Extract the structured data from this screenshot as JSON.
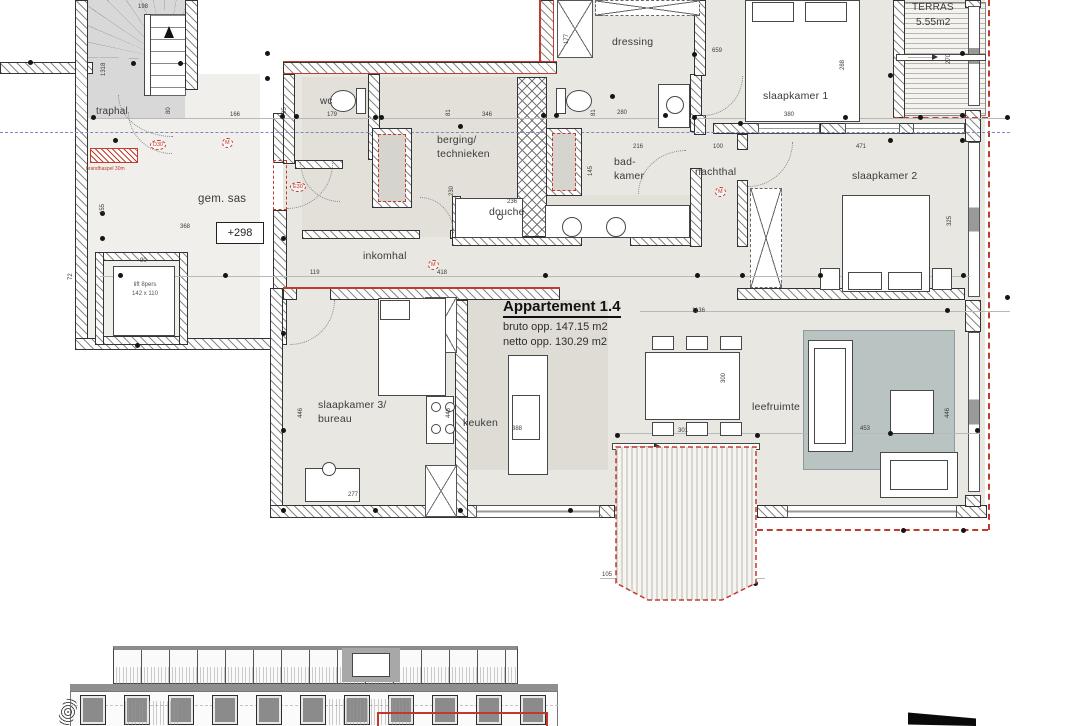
{
  "drawing": {
    "title": "Appartement 1.4",
    "bruto": "bruto opp. 147.15 m2",
    "netto": "netto opp. 130.29 m2",
    "level_marker": "+298",
    "fire_label": "brandhaspel 30m",
    "lift_line1": "lift 8pers",
    "lift_line2": "142 x 110"
  },
  "colors": {
    "accent_red": "#bf3d2e",
    "section_blue": "#7f88bd",
    "floor_beige": "#e9e7e1",
    "rug_gray": "#b9c3c2"
  },
  "room_labels": [
    {
      "text": "traphal",
      "x": 96,
      "y": 106,
      "fs": 10
    },
    {
      "text": "gem. sas",
      "x": 198,
      "y": 193,
      "fs": 11.5
    },
    {
      "text": "wc",
      "x": 320,
      "y": 96,
      "fs": 10
    },
    {
      "text": "berging/",
      "x": 437,
      "y": 134,
      "fs": 10.5
    },
    {
      "text": "technieken",
      "x": 437,
      "y": 148,
      "fs": 10.5
    },
    {
      "text": "douche",
      "x": 489,
      "y": 206,
      "fs": 10.5
    },
    {
      "text": "bad-",
      "x": 614,
      "y": 156,
      "fs": 10.5
    },
    {
      "text": "kamer",
      "x": 614,
      "y": 170,
      "fs": 10.5
    },
    {
      "text": "dressing",
      "x": 612,
      "y": 36,
      "fs": 10.5
    },
    {
      "text": "slaapkamer 1",
      "x": 763,
      "y": 90,
      "fs": 10.5
    },
    {
      "text": "nachthal",
      "x": 695,
      "y": 166,
      "fs": 10.5
    },
    {
      "text": "slaapkamer 2",
      "x": 852,
      "y": 170,
      "fs": 10.5
    },
    {
      "text": "inkomhal",
      "x": 363,
      "y": 250,
      "fs": 10.5
    },
    {
      "text": "slaapkamer 3/",
      "x": 318,
      "y": 399,
      "fs": 10.5
    },
    {
      "text": "bureau",
      "x": 318,
      "y": 413,
      "fs": 10.5
    },
    {
      "text": "keuken",
      "x": 463,
      "y": 417,
      "fs": 10.5
    },
    {
      "text": "leefruimte",
      "x": 752,
      "y": 401,
      "fs": 10.5
    }
  ],
  "terrace_labels": [
    {
      "text": "TERRAS",
      "x": 912,
      "y": 2,
      "fs": 10
    },
    {
      "text": "5.55m2",
      "x": 916,
      "y": 17,
      "fs": 10
    },
    {
      "text": "TERRAS",
      "x": 645,
      "y": 529,
      "fs": 11
    },
    {
      "text": "11.2m2",
      "x": 648,
      "y": 547,
      "fs": 11
    }
  ],
  "dimensions": [
    {
      "t": "198",
      "x": 138,
      "y": 4
    },
    {
      "t": "1318",
      "x": 107,
      "y": 58,
      "v": 1
    },
    {
      "t": "80",
      "x": 172,
      "y": 96,
      "v": 1
    },
    {
      "t": "155",
      "x": 106,
      "y": 196,
      "v": 1
    },
    {
      "t": "166",
      "x": 230,
      "y": 112
    },
    {
      "t": "368",
      "x": 180,
      "y": 224
    },
    {
      "t": "90",
      "x": 140,
      "y": 258
    },
    {
      "t": "72",
      "x": 74,
      "y": 262,
      "v": 1
    },
    {
      "t": "179",
      "x": 327,
      "y": 112
    },
    {
      "t": "95",
      "x": 288,
      "y": 96,
      "v": 1
    },
    {
      "t": "346",
      "x": 482,
      "y": 112
    },
    {
      "t": "81",
      "x": 452,
      "y": 98,
      "v": 1
    },
    {
      "t": "230",
      "x": 455,
      "y": 178,
      "v": 1
    },
    {
      "t": "280",
      "x": 617,
      "y": 110
    },
    {
      "t": "81",
      "x": 597,
      "y": 98,
      "v": 1
    },
    {
      "t": "216",
      "x": 633,
      "y": 144
    },
    {
      "t": "145",
      "x": 594,
      "y": 158,
      "v": 1
    },
    {
      "t": "100",
      "x": 713,
      "y": 144
    },
    {
      "t": "236",
      "x": 507,
      "y": 199
    },
    {
      "t": "119",
      "x": 310,
      "y": 270
    },
    {
      "t": "418",
      "x": 437,
      "y": 270
    },
    {
      "t": "659",
      "x": 712,
      "y": 48
    },
    {
      "t": "288",
      "x": 846,
      "y": 52,
      "v": 1
    },
    {
      "t": "177",
      "x": 570,
      "y": 26,
      "v": 1
    },
    {
      "t": "380",
      "x": 784,
      "y": 112
    },
    {
      "t": "471",
      "x": 856,
      "y": 144
    },
    {
      "t": "270",
      "x": 952,
      "y": 46,
      "v": 1
    },
    {
      "t": "1136",
      "x": 692,
      "y": 308
    },
    {
      "t": "446",
      "x": 304,
      "y": 400,
      "v": 1
    },
    {
      "t": "446",
      "x": 452,
      "y": 400,
      "v": 1
    },
    {
      "t": "277",
      "x": 348,
      "y": 492
    },
    {
      "t": "388",
      "x": 512,
      "y": 426
    },
    {
      "t": "300",
      "x": 727,
      "y": 365,
      "v": 1
    },
    {
      "t": "453",
      "x": 860,
      "y": 426
    },
    {
      "t": "446",
      "x": 951,
      "y": 400,
      "v": 1
    },
    {
      "t": "325",
      "x": 953,
      "y": 208,
      "v": 1
    },
    {
      "t": "301",
      "x": 678,
      "y": 428
    },
    {
      "t": "289",
      "x": 678,
      "y": 460
    },
    {
      "t": "172",
      "x": 738,
      "y": 482,
      "v": 1
    },
    {
      "t": "105",
      "x": 602,
      "y": 572
    },
    {
      "t": "247",
      "x": 684,
      "y": 572
    }
  ],
  "symbols": [
    {
      "t": "D30",
      "x": 150,
      "y": 140
    },
    {
      "t": "E30",
      "x": 290,
      "y": 182
    },
    {
      "t": "M",
      "x": 222,
      "y": 138
    },
    {
      "t": "M",
      "x": 428,
      "y": 260
    },
    {
      "t": "M",
      "x": 715,
      "y": 187
    }
  ],
  "dots": [
    [
      30,
      62
    ],
    [
      133,
      63
    ],
    [
      180,
      63
    ],
    [
      267,
      53
    ],
    [
      267,
      78
    ],
    [
      93,
      117
    ],
    [
      115,
      140
    ],
    [
      102,
      213
    ],
    [
      102,
      238
    ],
    [
      137,
      345
    ],
    [
      282,
      116
    ],
    [
      296,
      116
    ],
    [
      375,
      117
    ],
    [
      381,
      117
    ],
    [
      460,
      126
    ],
    [
      543,
      115
    ],
    [
      556,
      115
    ],
    [
      612,
      96
    ],
    [
      665,
      115
    ],
    [
      694,
      54
    ],
    [
      694,
      117
    ],
    [
      740,
      123
    ],
    [
      845,
      117
    ],
    [
      890,
      75
    ],
    [
      920,
      117
    ],
    [
      962,
      53
    ],
    [
      962,
      115
    ],
    [
      890,
      140
    ],
    [
      962,
      140
    ],
    [
      120,
      275
    ],
    [
      225,
      275
    ],
    [
      283,
      238
    ],
    [
      545,
      275
    ],
    [
      697,
      275
    ],
    [
      742,
      275
    ],
    [
      820,
      275
    ],
    [
      963,
      275
    ],
    [
      283,
      333
    ],
    [
      283,
      430
    ],
    [
      283,
      510
    ],
    [
      375,
      510
    ],
    [
      460,
      510
    ],
    [
      570,
      510
    ],
    [
      617,
      435
    ],
    [
      757,
      435
    ],
    [
      890,
      433
    ],
    [
      977,
      430
    ],
    [
      645,
      583
    ],
    [
      755,
      583
    ],
    [
      903,
      530
    ],
    [
      963,
      530
    ],
    [
      1007,
      117
    ],
    [
      1007,
      297
    ],
    [
      695,
      310
    ],
    [
      947,
      310
    ]
  ]
}
